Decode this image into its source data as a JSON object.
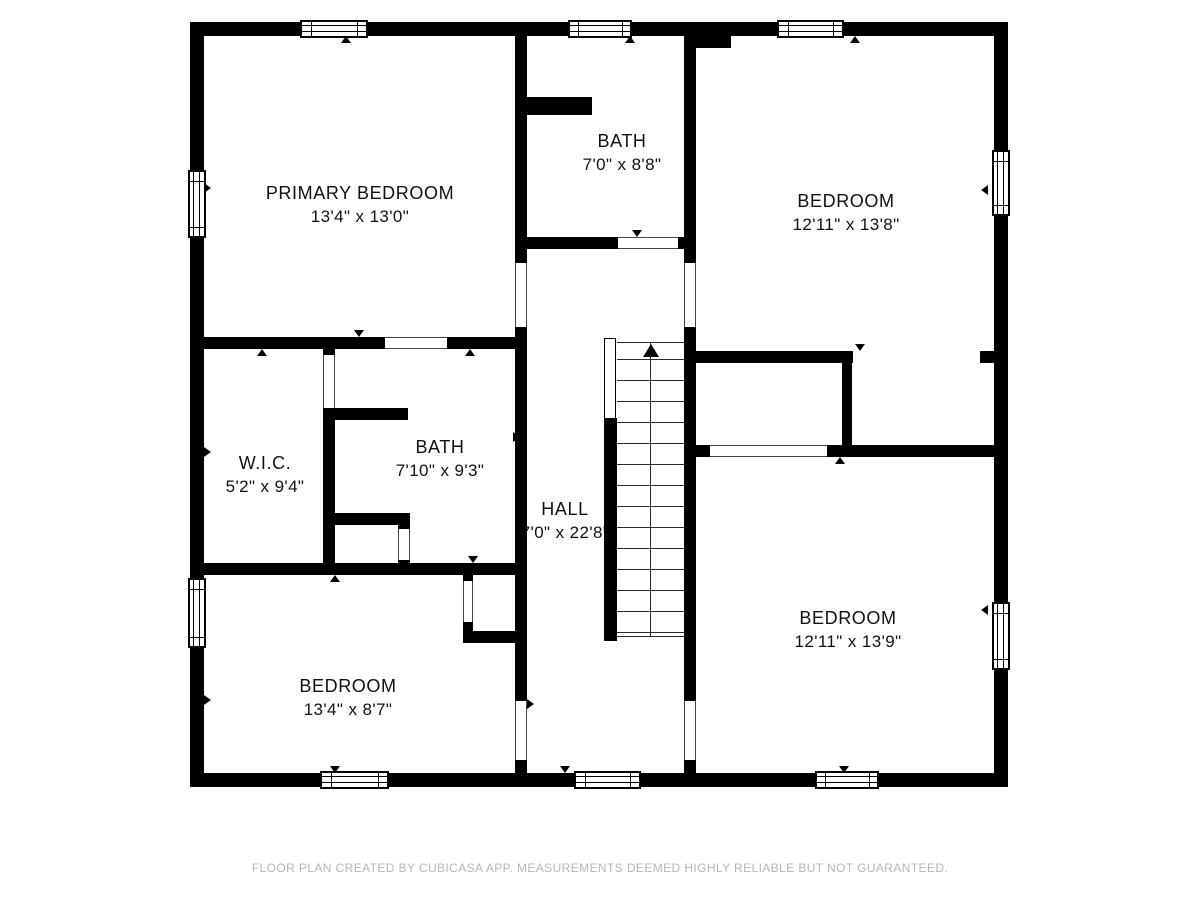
{
  "title": "Floor plan",
  "rooms": [
    {
      "id": "primary-bedroom",
      "name": "PRIMARY BEDROOM",
      "dims": "13'4\" x 13'0\""
    },
    {
      "id": "bath-upper",
      "name": "BATH",
      "dims": "7'0\" x 8'8\""
    },
    {
      "id": "bedroom-top-right",
      "name": "BEDROOM",
      "dims": "12'11\" x 13'8\""
    },
    {
      "id": "walk-in-closet",
      "name": "W.I.C.",
      "dims": "5'2\" x 9'4\""
    },
    {
      "id": "bath-middle",
      "name": "BATH",
      "dims": "7'10\" x 9'3\""
    },
    {
      "id": "hall",
      "name": "HALL",
      "dims": "7'0\" x 22'8\""
    },
    {
      "id": "bedroom-bottom-left",
      "name": "BEDROOM",
      "dims": "13'4\" x 8'7\""
    },
    {
      "id": "bedroom-bottom-right",
      "name": "BEDROOM",
      "dims": "12'11\" x 13'9\""
    }
  ],
  "stairs": {
    "direction": "up"
  },
  "colors": {
    "wall": "#000000",
    "background": "#ffffff",
    "footer_text": "#b5b5b5"
  },
  "footer": {
    "disclaimer": "FLOOR PLAN CREATED BY CUBICASA APP. MEASUREMENTS DEEMED HIGHLY RELIABLE BUT NOT GUARANTEED."
  }
}
